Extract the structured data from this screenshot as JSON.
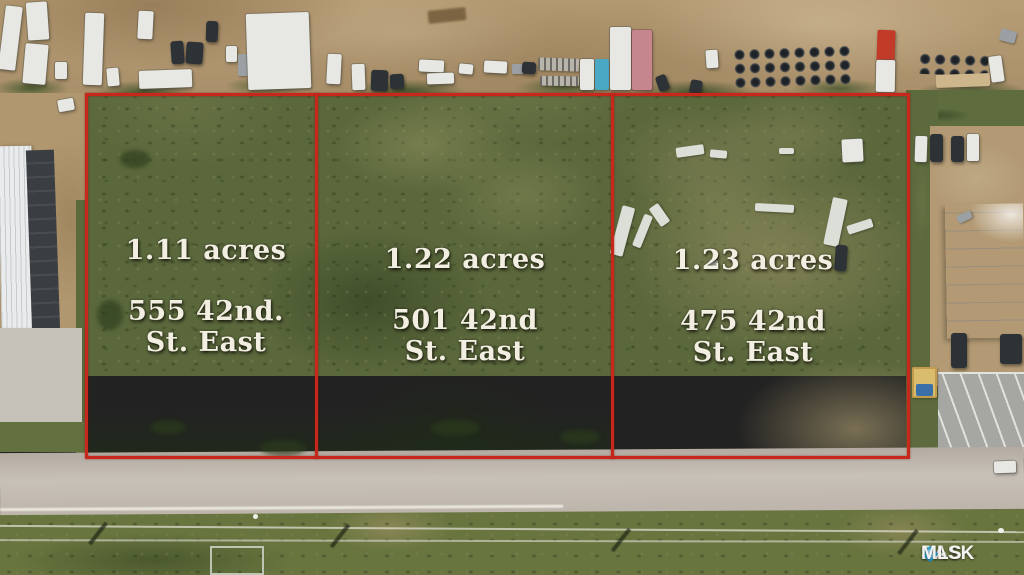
{
  "image_type": "aerial drone photo - real estate land listing with parcel boundary overlay",
  "parcels": [
    {
      "id": 1,
      "acreage": "1.11 acres",
      "address_line1": "555 42nd.",
      "address_line2": "St. East"
    },
    {
      "id": 2,
      "acreage": "1.22 acres",
      "address_line1": "501 42nd",
      "address_line2": "St. East"
    },
    {
      "id": 3,
      "acreage": "1.23 acres",
      "address_line1": "475 42nd",
      "address_line2": "St. East"
    }
  ],
  "watermark": {
    "brand_prefix": "SASK",
    "brand_suffix": "MLS",
    "registered_mark": "®"
  },
  "colors": {
    "boundary-red": "#c8271b",
    "label-text": "#f2eee1",
    "field-green": "#5b683c",
    "dirt-tan": "#b1976f",
    "road-gray": "#b3aba1",
    "watermark-text": "#f4f4f2",
    "watermark-diamond": "#2ba0d0"
  },
  "scene": {
    "description": "Three vacant grass parcels outlined in red between an industrial truck yard (top), buildings left/right, and 42nd Street East with a grass ditch and power lines (bottom).",
    "objects": [
      {
        "n": "semi-trailer",
        "x": 2,
        "y": 6,
        "w": 17,
        "h": 64,
        "c": "white",
        "r": 7
      },
      {
        "n": "trailer",
        "x": 27,
        "y": 2,
        "w": 21,
        "h": 38,
        "c": "white",
        "r": -4
      },
      {
        "n": "box-truck",
        "x": 24,
        "y": 44,
        "w": 23,
        "h": 40,
        "c": "white",
        "r": 5
      },
      {
        "n": "van",
        "x": 55,
        "y": 62,
        "w": 12,
        "h": 17,
        "c": "white",
        "r": 0
      },
      {
        "n": "rv",
        "x": 84,
        "y": 13,
        "w": 19,
        "h": 72,
        "c": "white",
        "r": 2
      },
      {
        "n": "car",
        "x": 107,
        "y": 68,
        "w": 12,
        "h": 18,
        "c": "white",
        "r": -5
      },
      {
        "n": "rv",
        "x": 138,
        "y": 11,
        "w": 15,
        "h": 28,
        "c": "white",
        "r": 3
      },
      {
        "n": "flatbed-trailer",
        "x": 139,
        "y": 70,
        "w": 53,
        "h": 18,
        "c": "white",
        "r": -2
      },
      {
        "n": "car",
        "x": 171,
        "y": 41,
        "w": 13,
        "h": 23,
        "c": "dark",
        "r": -4
      },
      {
        "n": "car",
        "x": 186,
        "y": 42,
        "w": 17,
        "h": 22,
        "c": "dark",
        "r": 4
      },
      {
        "n": "car",
        "x": 206,
        "y": 21,
        "w": 12,
        "h": 21,
        "c": "dark",
        "r": 2
      },
      {
        "n": "van",
        "x": 226,
        "y": 46,
        "w": 11,
        "h": 16,
        "c": "white",
        "r": 0
      },
      {
        "n": "van",
        "x": 238,
        "y": 54,
        "w": 11,
        "h": 22,
        "c": "gray",
        "r": 0
      },
      {
        "n": "warehouse-roof",
        "x": 247,
        "y": 13,
        "w": 63,
        "h": 76,
        "c": "white",
        "r": -2
      },
      {
        "n": "truck",
        "x": 327,
        "y": 54,
        "w": 14,
        "h": 30,
        "c": "white",
        "r": 3
      },
      {
        "n": "truck",
        "x": 352,
        "y": 64,
        "w": 13,
        "h": 26,
        "c": "white",
        "r": -2
      },
      {
        "n": "pallet-stack",
        "x": 371,
        "y": 70,
        "w": 17,
        "h": 21,
        "c": "dark",
        "r": 2
      },
      {
        "n": "pallet-stack",
        "x": 390,
        "y": 74,
        "w": 14,
        "h": 15,
        "c": "dark",
        "r": -3
      },
      {
        "n": "dirt-mound",
        "x": 428,
        "y": 9,
        "w": 38,
        "h": 13,
        "c": "dirtdark",
        "r": -6
      },
      {
        "n": "equipment-trailer",
        "x": 419,
        "y": 60,
        "w": 25,
        "h": 12,
        "c": "white",
        "r": 3
      },
      {
        "n": "equipment-trailer",
        "x": 427,
        "y": 73,
        "w": 27,
        "h": 11,
        "c": "white",
        "r": -2
      },
      {
        "n": "shed",
        "x": 459,
        "y": 64,
        "w": 14,
        "h": 10,
        "c": "white",
        "r": 6
      },
      {
        "n": "shed",
        "x": 484,
        "y": 61,
        "w": 23,
        "h": 12,
        "c": "white",
        "r": 3
      },
      {
        "n": "crate",
        "x": 512,
        "y": 64,
        "w": 12,
        "h": 10,
        "c": "gray",
        "r": 0
      },
      {
        "n": "crate",
        "x": 522,
        "y": 62,
        "w": 14,
        "h": 12,
        "c": "dark",
        "r": 4
      },
      {
        "n": "pallet-rack",
        "x": 538,
        "y": 58,
        "w": 41,
        "h": 13,
        "c": "rack",
        "r": 2
      },
      {
        "n": "pallet-rack",
        "x": 540,
        "y": 76,
        "w": 39,
        "h": 10,
        "c": "rack",
        "r": 1
      },
      {
        "n": "trailer",
        "x": 580,
        "y": 59,
        "w": 14,
        "h": 31,
        "c": "white",
        "r": 0
      },
      {
        "n": "shipping-container-blue",
        "x": 595,
        "y": 59,
        "w": 14,
        "h": 31,
        "c": "blue",
        "r": 0
      },
      {
        "n": "warehouse-white",
        "x": 610,
        "y": 27,
        "w": 21,
        "h": 63,
        "c": "white",
        "r": 0
      },
      {
        "n": "building-pink",
        "x": 632,
        "y": 30,
        "w": 20,
        "h": 60,
        "c": "pink",
        "r": 0
      },
      {
        "n": "car",
        "x": 657,
        "y": 75,
        "w": 11,
        "h": 16,
        "c": "dark",
        "r": -20
      },
      {
        "n": "car",
        "x": 690,
        "y": 80,
        "w": 12,
        "h": 14,
        "c": "dark",
        "r": 10
      },
      {
        "n": "truck",
        "x": 706,
        "y": 50,
        "w": 12,
        "h": 18,
        "c": "white",
        "r": -4
      },
      {
        "n": "tire-stacks",
        "x": 733,
        "y": 46,
        "w": 118,
        "h": 44,
        "c": "tires",
        "r": -2
      },
      {
        "n": "tire-stacks",
        "x": 918,
        "y": 53,
        "w": 70,
        "h": 22,
        "c": "tires",
        "r": 2
      },
      {
        "n": "crane-truck-red",
        "x": 877,
        "y": 30,
        "w": 18,
        "h": 32,
        "c": "red",
        "r": 2
      },
      {
        "n": "trailer",
        "x": 876,
        "y": 60,
        "w": 19,
        "h": 32,
        "c": "white",
        "r": 1
      },
      {
        "n": "lumber-pile",
        "x": 936,
        "y": 74,
        "w": 54,
        "h": 13,
        "c": "tan",
        "r": -2
      },
      {
        "n": "truck",
        "x": 990,
        "y": 56,
        "w": 13,
        "h": 26,
        "c": "white",
        "r": -8
      },
      {
        "n": "equipment",
        "x": 1000,
        "y": 30,
        "w": 16,
        "h": 12,
        "c": "gray",
        "r": 15
      },
      {
        "n": "van",
        "x": 58,
        "y": 99,
        "w": 16,
        "h": 12,
        "c": "white",
        "r": -10
      },
      {
        "n": "car",
        "x": 915,
        "y": 136,
        "w": 12,
        "h": 26,
        "c": "white",
        "r": 2
      },
      {
        "n": "car",
        "x": 930,
        "y": 134,
        "w": 13,
        "h": 28,
        "c": "dark",
        "r": 0
      },
      {
        "n": "car",
        "x": 951,
        "y": 136,
        "w": 13,
        "h": 26,
        "c": "dark",
        "r": 0
      },
      {
        "n": "pickup-truck",
        "x": 967,
        "y": 134,
        "w": 12,
        "h": 27,
        "c": "white",
        "r": 0
      },
      {
        "n": "car",
        "x": 957,
        "y": 213,
        "w": 15,
        "h": 8,
        "c": "gray",
        "r": -25
      },
      {
        "n": "dock-truck",
        "x": 951,
        "y": 333,
        "w": 16,
        "h": 35,
        "c": "dark",
        "r": 0
      },
      {
        "n": "dock-truck",
        "x": 1000,
        "y": 334,
        "w": 22,
        "h": 30,
        "c": "dark",
        "r": 0
      },
      {
        "n": "shed-yellow",
        "x": 912,
        "y": 367,
        "w": 25,
        "h": 31,
        "c": "yellow",
        "r": 0
      },
      {
        "n": "dumpster-blue",
        "x": 916,
        "y": 384,
        "w": 17,
        "h": 12,
        "c": "blue2",
        "r": 0
      },
      {
        "n": "car-on-road",
        "x": 994,
        "y": 461,
        "w": 22,
        "h": 12,
        "c": "white",
        "r": -2
      },
      {
        "n": "debris",
        "x": 676,
        "y": 146,
        "w": 28,
        "h": 10,
        "c": "debris",
        "r": -8
      },
      {
        "n": "debris",
        "x": 710,
        "y": 150,
        "w": 17,
        "h": 8,
        "c": "debris",
        "r": 5
      },
      {
        "n": "shed",
        "x": 842,
        "y": 139,
        "w": 21,
        "h": 23,
        "c": "white",
        "r": -3
      },
      {
        "n": "debris",
        "x": 779,
        "y": 148,
        "w": 15,
        "h": 6,
        "c": "debris",
        "r": 0
      },
      {
        "n": "debris",
        "x": 616,
        "y": 206,
        "w": 13,
        "h": 50,
        "c": "debris",
        "r": 15
      },
      {
        "n": "debris",
        "x": 638,
        "y": 214,
        "w": 9,
        "h": 34,
        "c": "debris",
        "r": 22
      },
      {
        "n": "debris",
        "x": 654,
        "y": 204,
        "w": 11,
        "h": 22,
        "c": "debris",
        "r": -35
      },
      {
        "n": "debris",
        "x": 755,
        "y": 204,
        "w": 39,
        "h": 8,
        "c": "debris",
        "r": 3
      },
      {
        "n": "debris",
        "x": 828,
        "y": 198,
        "w": 15,
        "h": 48,
        "c": "debris",
        "r": 12
      },
      {
        "n": "trailer",
        "x": 847,
        "y": 222,
        "w": 26,
        "h": 9,
        "c": "debris",
        "r": -18
      },
      {
        "n": "equipment",
        "x": 835,
        "y": 245,
        "w": 12,
        "h": 26,
        "c": "dark",
        "r": 4
      },
      {
        "n": "debris",
        "x": 709,
        "y": 260,
        "w": 9,
        "h": 6,
        "c": "debris",
        "r": 0
      },
      {
        "n": "bush",
        "x": 120,
        "y": 150,
        "w": 30,
        "h": 18,
        "c": "grassdot",
        "r": 0
      },
      {
        "n": "bush",
        "x": 97,
        "y": 300,
        "w": 26,
        "h": 30,
        "c": "grassdot",
        "r": 0
      },
      {
        "n": "bush",
        "x": 150,
        "y": 420,
        "w": 36,
        "h": 14,
        "c": "grassdot",
        "r": 0
      },
      {
        "n": "bush",
        "x": 260,
        "y": 440,
        "w": 46,
        "h": 16,
        "c": "grassdot",
        "r": 0
      },
      {
        "n": "bush",
        "x": 430,
        "y": 420,
        "w": 50,
        "h": 16,
        "c": "grassdot",
        "r": 0
      },
      {
        "n": "bush",
        "x": 560,
        "y": 430,
        "w": 40,
        "h": 14,
        "c": "grassdot",
        "r": 0
      },
      {
        "n": "pole-shadow",
        "x": 96,
        "y": 520,
        "w": 4,
        "h": 27,
        "c": "shadow",
        "r": 38
      },
      {
        "n": "pole-shadow",
        "x": 338,
        "y": 522,
        "w": 4,
        "h": 28,
        "c": "shadow",
        "r": 38
      },
      {
        "n": "pole-shadow",
        "x": 619,
        "y": 526,
        "w": 4,
        "h": 28,
        "c": "shadow",
        "r": 38
      },
      {
        "n": "pole-shadow",
        "x": 906,
        "y": 527,
        "w": 4,
        "h": 30,
        "c": "shadow",
        "r": 38
      },
      {
        "n": "pole-top",
        "x": 253,
        "y": 514,
        "w": 5,
        "h": 5,
        "c": "whitedot",
        "r": 0
      },
      {
        "n": "pole-top",
        "x": 998,
        "y": 528,
        "w": 6,
        "h": 5,
        "c": "whitedot",
        "r": 0
      }
    ]
  }
}
